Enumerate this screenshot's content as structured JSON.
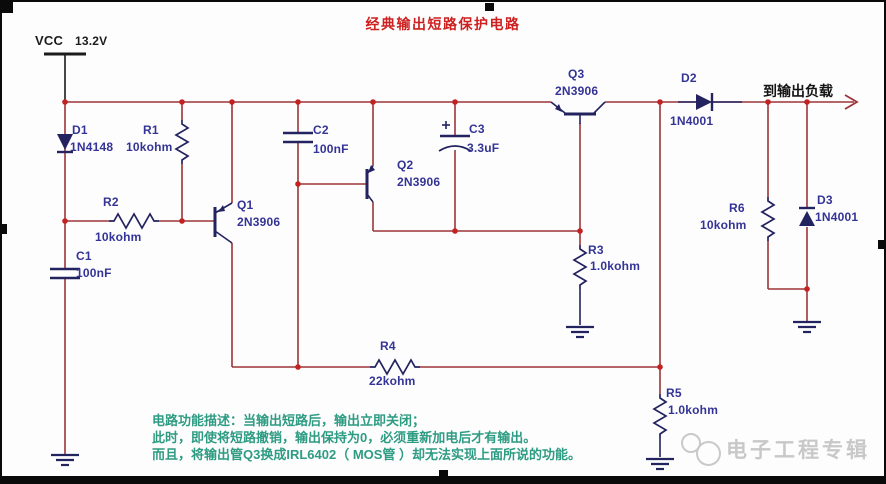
{
  "title": "经典输出短路保护电路",
  "power": {
    "net": "VCC",
    "voltage": "13.2V"
  },
  "output": {
    "label": "到输出负载"
  },
  "components": {
    "D1": {
      "ref": "D1",
      "value": "1N4148"
    },
    "R1": {
      "ref": "R1",
      "value": "10kohm"
    },
    "R2": {
      "ref": "R2",
      "value": "10kohm"
    },
    "C1": {
      "ref": "C1",
      "value": "100nF"
    },
    "Q1": {
      "ref": "Q1",
      "value": "2N3906"
    },
    "C2": {
      "ref": "C2",
      "value": "100nF"
    },
    "Q2": {
      "ref": "Q2",
      "value": "2N3906"
    },
    "C3": {
      "ref": "C3",
      "value": "3.3uF"
    },
    "Q3": {
      "ref": "Q3",
      "value": "2N3906"
    },
    "D2": {
      "ref": "D2",
      "value": "1N4001"
    },
    "R3": {
      "ref": "R3",
      "value": "1.0kohm"
    },
    "R4": {
      "ref": "R4",
      "value": "22kohm"
    },
    "R5": {
      "ref": "R5",
      "value": "1.0kohm"
    },
    "R6": {
      "ref": "R6",
      "value": "10kohm"
    },
    "D3": {
      "ref": "D3",
      "value": "1N4001"
    }
  },
  "notes": [
    "电路功能描述：当输出短路后，输出立即关闭；",
    "此时，即使将短路撤销，输出保持为0，必须重新加电后才有输出。",
    "而且，将输出管Q3换成IRL6402（ MOS管 ）却无法实现上面所说的功能。"
  ],
  "watermark": {
    "text": "电子工程专辑"
  },
  "colors": {
    "wire": "#9b3538",
    "junction": "#c32222",
    "symbol": "#232360",
    "component_label": "#343496",
    "title": "#cf2020",
    "note_text": "#2e9b83",
    "power_text": "#1c1c1c",
    "watermark": "#c8c8c8"
  }
}
